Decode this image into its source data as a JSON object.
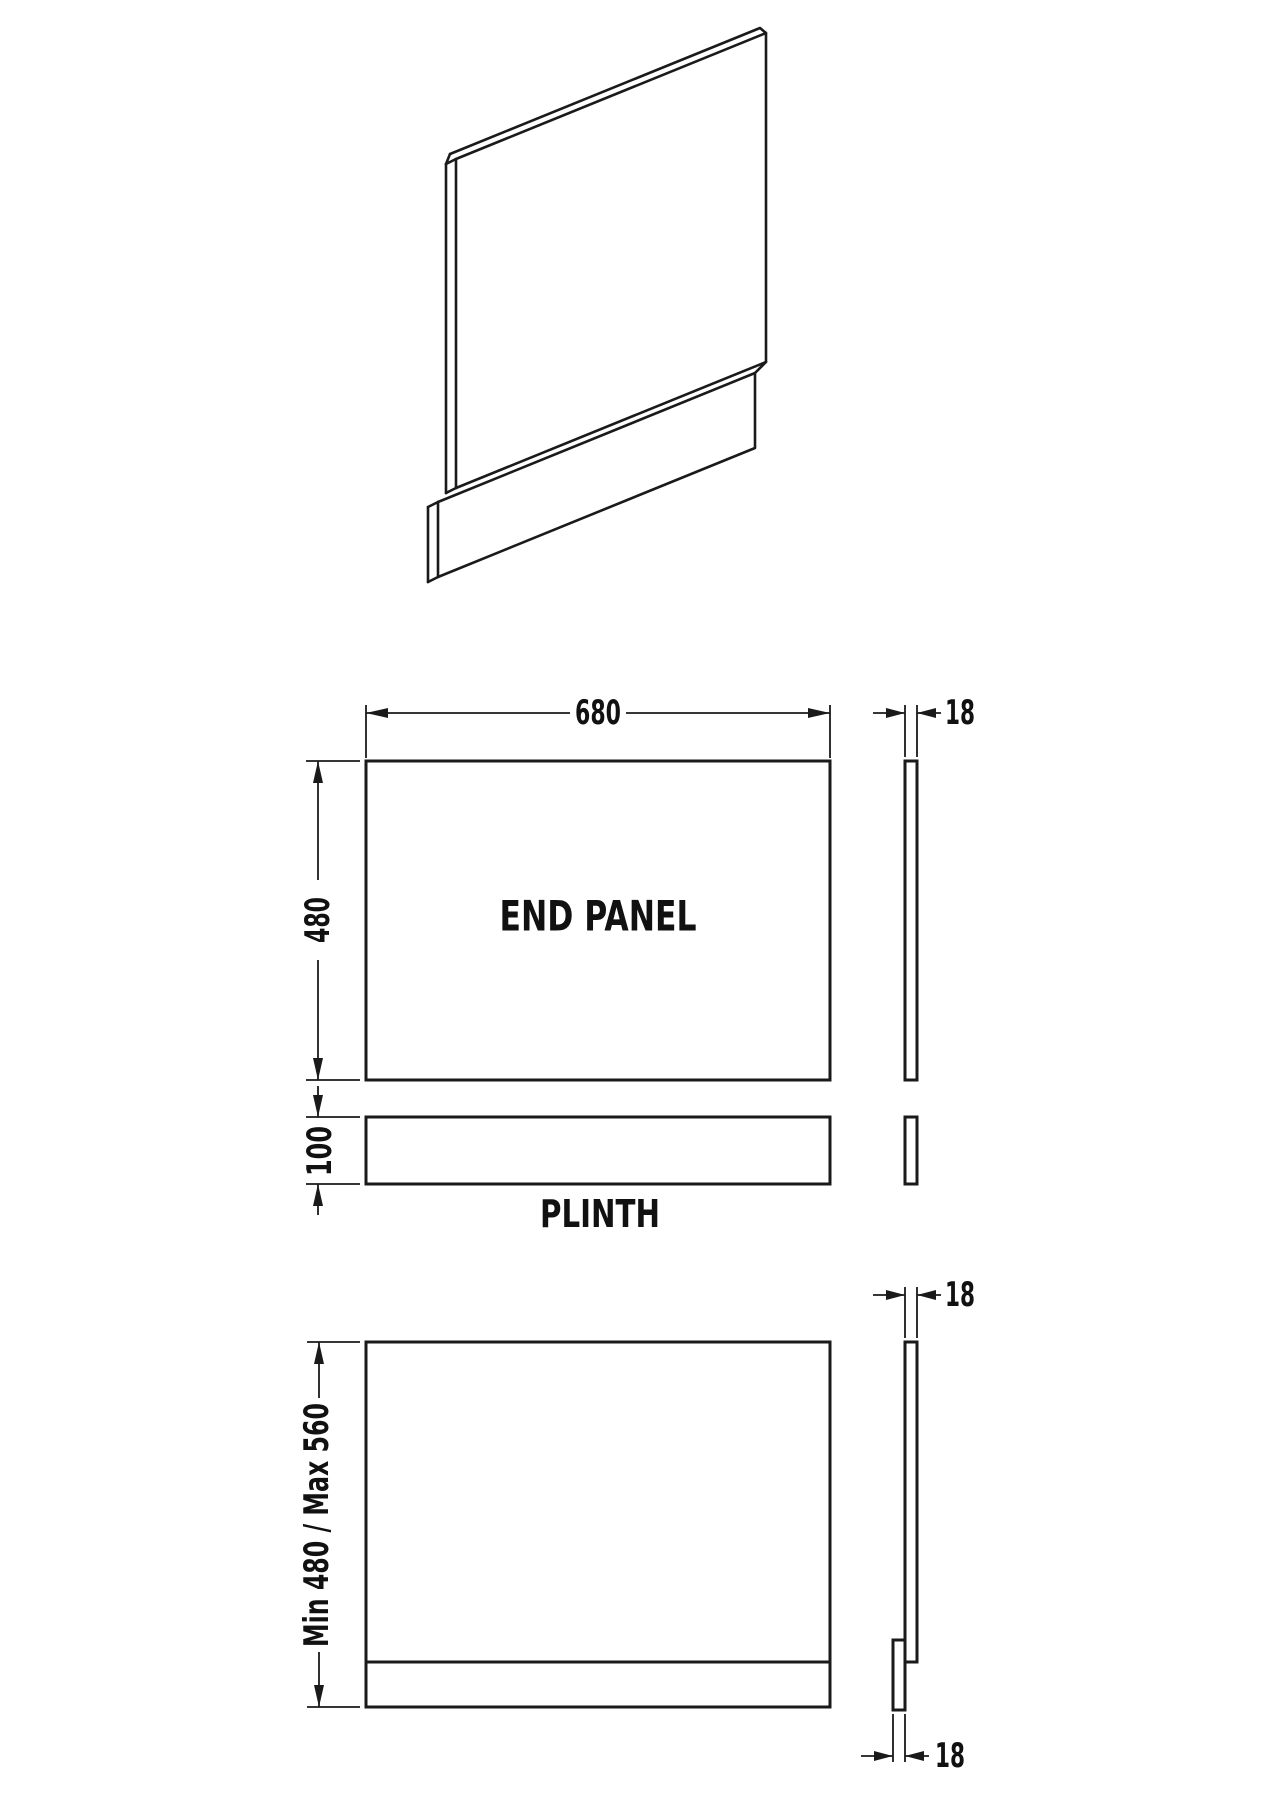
{
  "page": {
    "background": "#ffffff",
    "line_color": "#1a1a1a"
  },
  "views": {
    "isometric": {
      "description": "bath end panel with plinth, 3d line view"
    },
    "front": {
      "label": "END PANEL",
      "width_dim": "680",
      "height_dim": "480",
      "thickness_dim": "18"
    },
    "plinth": {
      "label": "PLINTH",
      "height_dim": "100"
    },
    "assembled": {
      "height_range_dim": "Min 480 / Max 560",
      "thickness_top_dim": "18",
      "thickness_bottom_dim": "18"
    }
  }
}
